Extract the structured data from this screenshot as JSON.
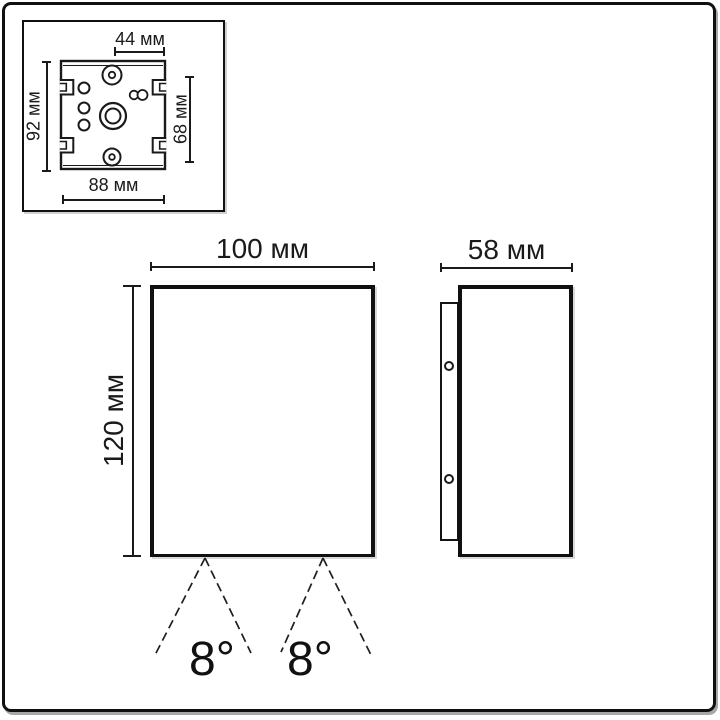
{
  "drawing": {
    "inset": {
      "top_label": "44 мм",
      "left_label": "92 мм",
      "right_label": "68 мм",
      "bottom_label": "88 мм"
    },
    "front_view": {
      "width_label": "100 мм",
      "height_label": "120 мм",
      "beam_angle_left": "8°",
      "beam_angle_right": "8°"
    },
    "side_view": {
      "depth_label": "58 мм"
    },
    "colors": {
      "ink": "#1a1a1a",
      "background": "#ffffff"
    }
  }
}
